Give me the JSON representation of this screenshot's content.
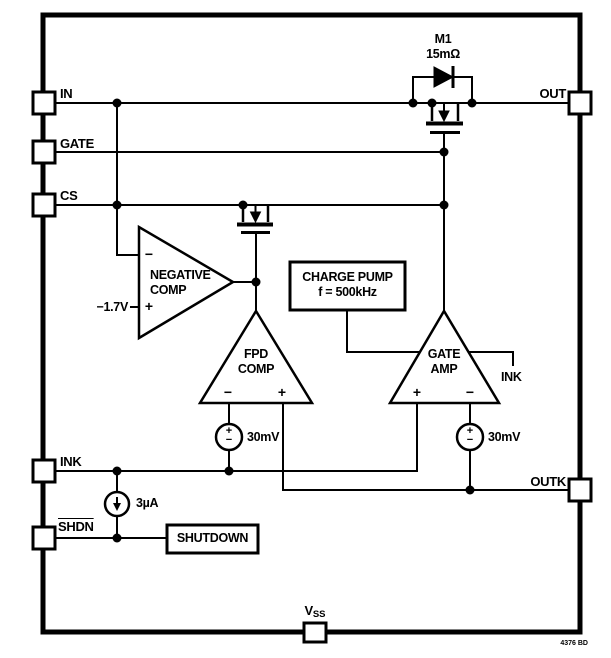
{
  "diagram_title": "LTC4376 ideal diode block diagram",
  "footer": {
    "code": "4376 BD"
  },
  "colors": {
    "line": "#000000",
    "background": "#ffffff"
  },
  "pins": {
    "in": "IN",
    "gate": "GATE",
    "cs": "CS",
    "ink": "INK",
    "shdn": "SHDN",
    "out": "OUT",
    "outk": "OUTK",
    "vss_base": "V",
    "vss_sub": "SS"
  },
  "mosfet_m1": {
    "name": "M1",
    "resistance": "15mΩ"
  },
  "blocks": {
    "charge_pump_line1": "CHARGE PUMP",
    "charge_pump_line2": "f = 500kHz",
    "shutdown": "SHUTDOWN"
  },
  "amplifiers": {
    "negative_comp": {
      "line1": "NEGATIVE",
      "line2": "COMP",
      "minus": "−",
      "plus": "+",
      "ref": "−1.7V"
    },
    "fpd_comp": {
      "line1": "FPD",
      "line2": "COMP",
      "minus": "−",
      "plus": "+"
    },
    "gate_amp": {
      "line1": "GATE",
      "line2": "AMP",
      "plus": "+",
      "minus": "−",
      "supply_label": "INK"
    }
  },
  "sources": {
    "left_offset": {
      "label": "30mV",
      "symbol": "+\n−"
    },
    "right_offset": {
      "label": "30mV",
      "symbol": "+\n−"
    },
    "pulldown": {
      "label": "3µA"
    }
  }
}
